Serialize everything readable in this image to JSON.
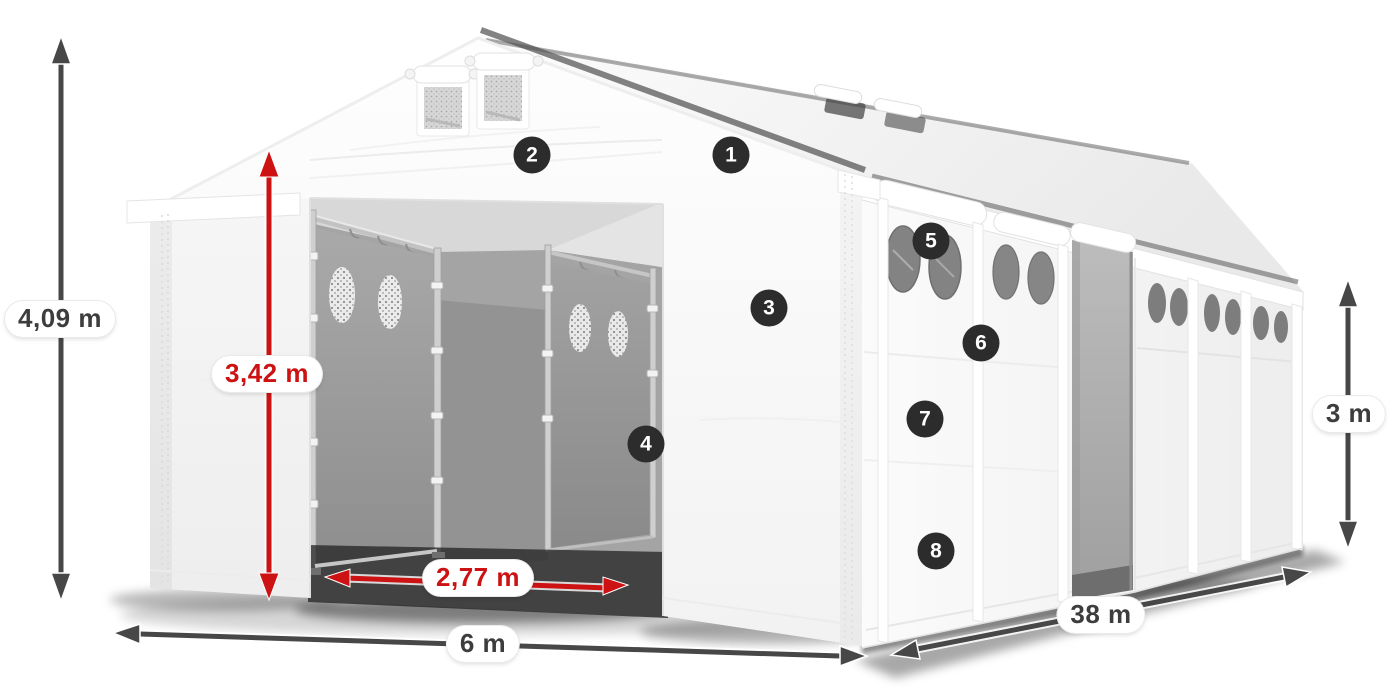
{
  "illustration": {
    "subject": "white storage tent / marquee shown in perspective with front entrance open",
    "view": "front-left perspective product dimension diagram"
  },
  "dimensions": {
    "total_height": "4,09 m",
    "entrance_height": "3,42 m",
    "entrance_width": "2,77 m",
    "front_width": "6 m",
    "length": "38 m",
    "side_height": "3 m"
  },
  "markers": [
    "1",
    "2",
    "3",
    "4",
    "5",
    "6",
    "7",
    "8"
  ],
  "colors": {
    "dimension_red": "#cc1212",
    "dimension_gray": "#474747",
    "marker_background": "#2c2c2c",
    "marker_text": "#ffffff",
    "label_text": "#3d3d3d",
    "tent_white": "#fafafa",
    "interior_gray": "#9c9c9c"
  }
}
